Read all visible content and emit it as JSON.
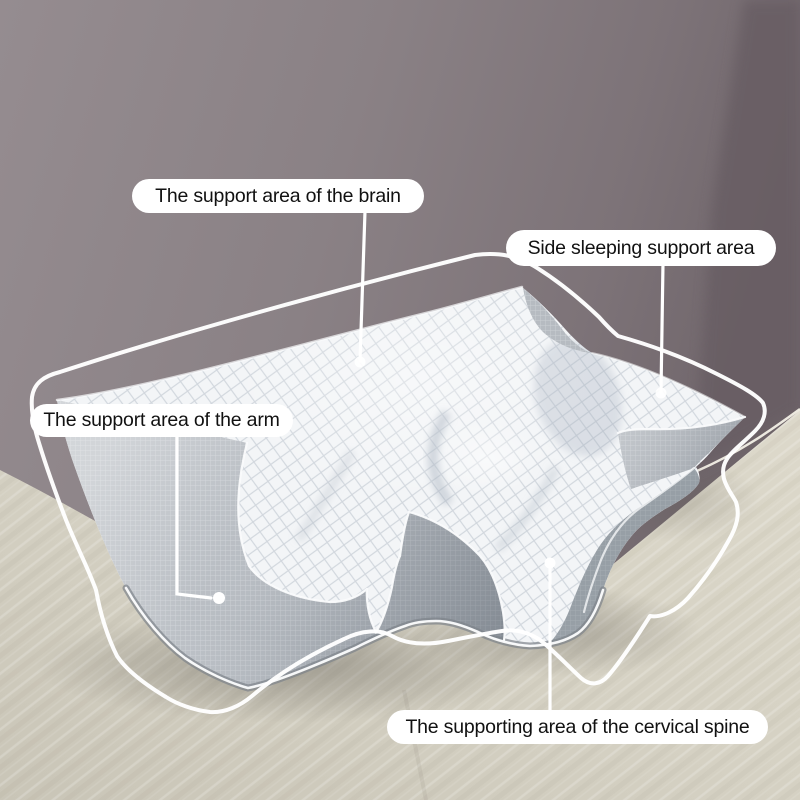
{
  "annotations": {
    "brain": {
      "text": "The support area of the brain"
    },
    "side": {
      "text": "Side sleeping support area"
    },
    "arm": {
      "text": "The support area of the arm"
    },
    "cervical": {
      "text": "The supporting area of the cervical spine"
    }
  },
  "colors": {
    "wall": "#8d8488",
    "wall_dark": "#6a6066",
    "surface": "#d5d1c3",
    "pillow_white": "#f3f5f7",
    "pillow_gray": "#b6bbc1",
    "contour_outline": "#ffffff",
    "label_background": "#ffffff",
    "label_text": "#111111"
  }
}
